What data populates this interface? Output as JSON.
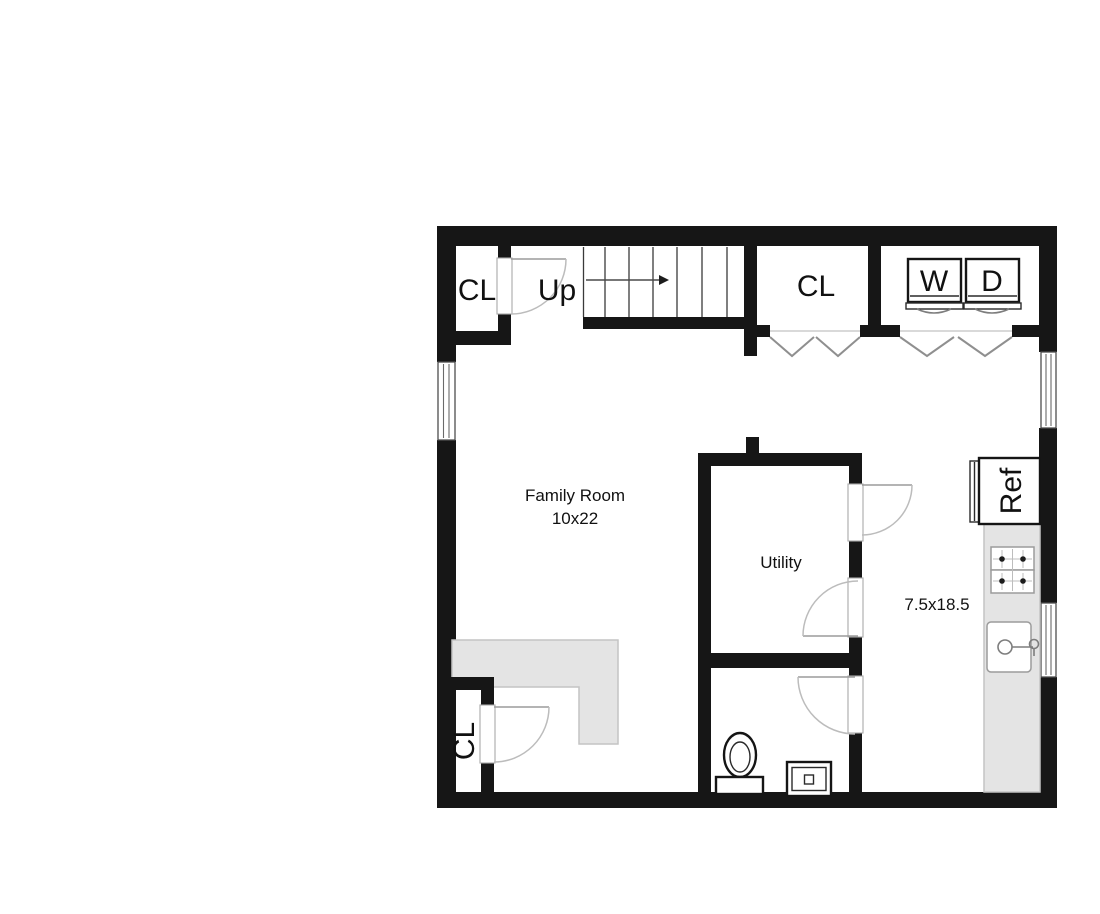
{
  "floorplan": {
    "labels": {
      "closet_top_left": "CL",
      "stairs_direction": "Up",
      "closet_top_right": "CL",
      "washer": "W",
      "dryer": "D",
      "refrigerator": "Ref",
      "family_room_name": "Family Room",
      "family_room_dimensions": "10x22",
      "utility_room": "Utility",
      "kitchen_dimensions": "7.5x18.5",
      "closet_bottom_left": "CL"
    },
    "colors": {
      "wall": "#161616",
      "background": "#ffffff",
      "counter_fill": "#e4e4e4",
      "counter_border": "#c4c4c4",
      "door_arc": "#bcbcbc",
      "fixture_line": "#8f8f8f",
      "text_color": "#111111"
    }
  }
}
